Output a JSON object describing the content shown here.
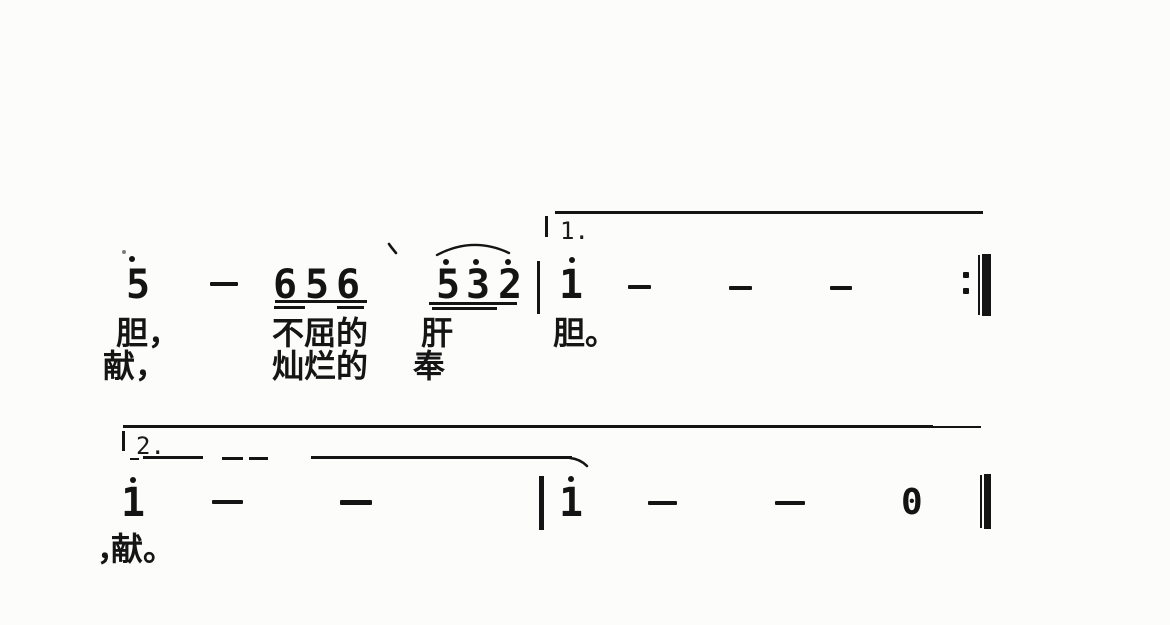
{
  "page": {
    "background": "#fcfcfa",
    "ink": "#141414",
    "kind": "scanned jianpu sheet music fragment"
  },
  "score": {
    "system1": {
      "volta_label": "1.",
      "notes_sequence": "5 — 656 532 | 1 — — — :‖",
      "notes": {
        "n5": "5",
        "g656": [
          "6",
          "5",
          "6"
        ],
        "g532": [
          "5",
          "3",
          "2"
        ],
        "n1": "1"
      },
      "lyrics_verse1": [
        "胆，",
        "不屈的",
        "肝",
        "胆。"
      ],
      "lyrics_verse2": [
        "献，",
        "灿烂的",
        "奉"
      ]
    },
    "system2": {
      "volta_label": "2.",
      "notes_sequence": "1 — — | 1 — — 0 ‖",
      "notes": {
        "n1": "1",
        "n2": "1",
        "rest": "0"
      },
      "lyric_comma": "，",
      "lyric_word": "献。"
    }
  }
}
